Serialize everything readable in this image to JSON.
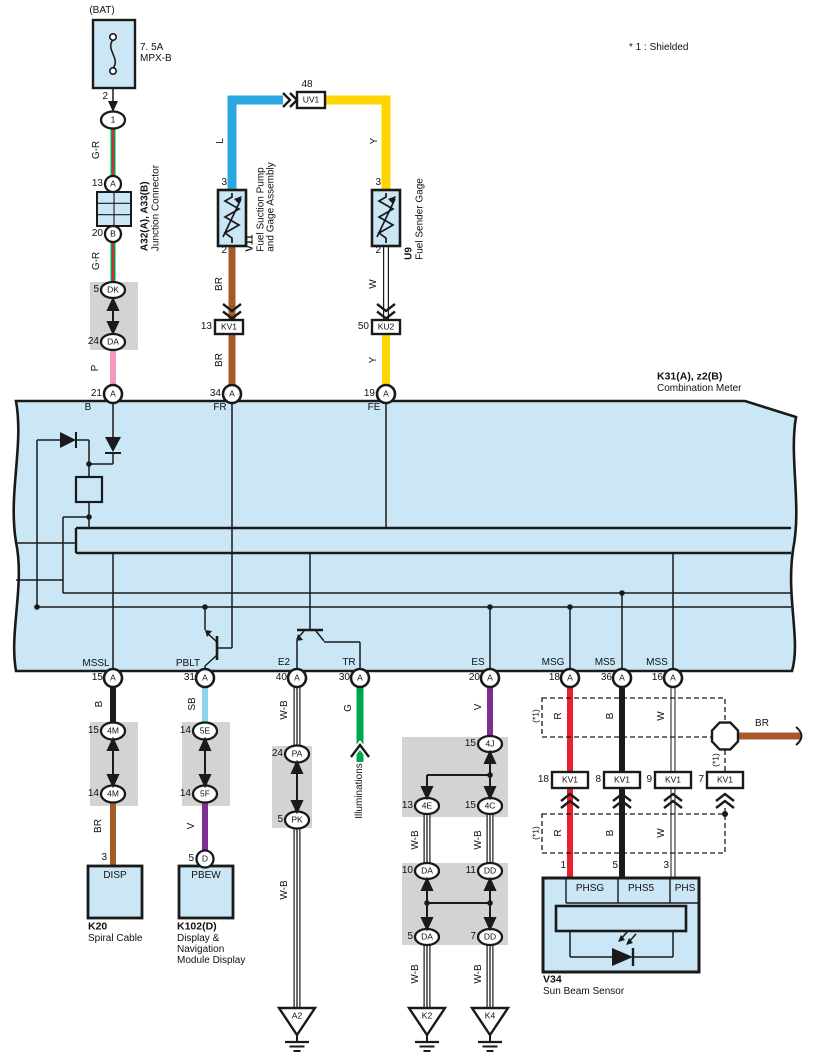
{
  "note": "* 1 : Shielded",
  "bat": {
    "src": "(BAT)",
    "amp": "7. 5A",
    "fuse": "MPX-B",
    "p2": "2",
    "c1": "1",
    "w1": "G-R",
    "p13": "13",
    "cA": "A",
    "jcode": "A32(A), A33(B)",
    "jname": "Junction Connector",
    "p20": "20",
    "cB": "B",
    "w2": "G-R",
    "p5": "5",
    "cDK": "DK",
    "p24": "24",
    "cDA": "DA",
    "w3": "P",
    "p21": "21",
    "cA2": "A"
  },
  "v11": {
    "p48": "48",
    "uv1": "UV1",
    "wL": "L",
    "p3": "3",
    "code": "V11",
    "n1": "Fuel Suction Pump",
    "n2": "and Gage Assembly",
    "p2": "2",
    "w1": "BR",
    "p13": "13",
    "kv1": "KV1",
    "w2": "BR",
    "p34": "34",
    "cA": "A"
  },
  "u9": {
    "w1": "Y",
    "p3": "3",
    "code": "U9",
    "name": "Fuel Sender Gage",
    "p2": "2",
    "w2": "W",
    "p50": "50",
    "ku2": "KU2",
    "w3": "Y",
    "p19": "19",
    "cA": "A"
  },
  "meter": {
    "code": "K31(A), z2(B)",
    "name": "Combination Meter",
    "tp": [
      "B",
      "FR",
      "FE"
    ],
    "bp": [
      {
        "l": "MSSL",
        "n": "15",
        "c": "A"
      },
      {
        "l": "PBLT",
        "n": "31",
        "c": "A"
      },
      {
        "l": "E2",
        "n": "40",
        "c": "A"
      },
      {
        "l": "TR",
        "n": "30",
        "c": "A"
      },
      {
        "l": "ES",
        "n": "20",
        "c": "A"
      },
      {
        "l": "MSG",
        "n": "18",
        "c": "A"
      },
      {
        "l": "MS5",
        "n": "36",
        "c": "A"
      },
      {
        "l": "MSS",
        "n": "16",
        "c": "A"
      }
    ]
  },
  "k20": {
    "w1": "B",
    "p15": "15",
    "c1": "4M",
    "p14": "14",
    "c2": "4M",
    "w2": "BR",
    "p3": "3",
    "pin": "DISP",
    "code": "K20",
    "name": "Spiral Cable"
  },
  "k102": {
    "w1": "SB",
    "p14a": "14",
    "c1": "5E",
    "p14b": "14",
    "c2": "5F",
    "w2": "V",
    "p5": "5",
    "cD": "D",
    "pin": "PBEW",
    "code": "K102(D)",
    "n1": "Display &",
    "n2": "Navigation",
    "n3": "Module Display"
  },
  "e2": {
    "w1": "W-B",
    "p24": "24",
    "c1": "PA",
    "p5": "5",
    "c2": "PK",
    "w2": "W-B",
    "gnd": "A2"
  },
  "tr": {
    "w1": "G",
    "dest": "Illuminations"
  },
  "es": {
    "w1": "V",
    "p15a": "15",
    "c4j": "4J",
    "p13": "13",
    "c4e": "4E",
    "p15b": "15",
    "c4c": "4C",
    "wl1": "W-B",
    "wr1": "W-B",
    "p10": "10",
    "cda1": "DA",
    "p11": "11",
    "cdd1": "DD",
    "p5": "5",
    "cda2": "DA",
    "p7": "7",
    "cdd2": "DD",
    "wl2": "W-B",
    "wr2": "W-B",
    "gk2": "K2",
    "gk4": "K4"
  },
  "sns": {
    "sh1": "(*1)",
    "sh2": "(*1)",
    "sh3": "(*1)",
    "r1": "R",
    "b1": "B",
    "w1": "W",
    "r2": "R",
    "b2": "B",
    "w2": "W",
    "br": "BR",
    "p18": "18",
    "p8": "8",
    "p9": "9",
    "p7": "7",
    "kv1": "KV1",
    "p1": "1",
    "p5": "5",
    "p3": "3",
    "phsg": "PHSG",
    "phs5": "PHS5",
    "phs": "PHS",
    "code": "V34",
    "name": "Sun Beam Sensor"
  },
  "colors": {
    "panel": "#cbe7f5",
    "gray": "#d3d3d3",
    "black": "#1a1a1a",
    "wire_blue": "#29a8df",
    "wire_yellow": "#ffd500",
    "wire_brown": "#a55a2a",
    "wire_pink": "#f498c0",
    "wire_skyblue": "#8ed4ee",
    "wire_violet": "#7d3090",
    "wire_green": "#00a550",
    "wire_red": "#e8212e"
  }
}
